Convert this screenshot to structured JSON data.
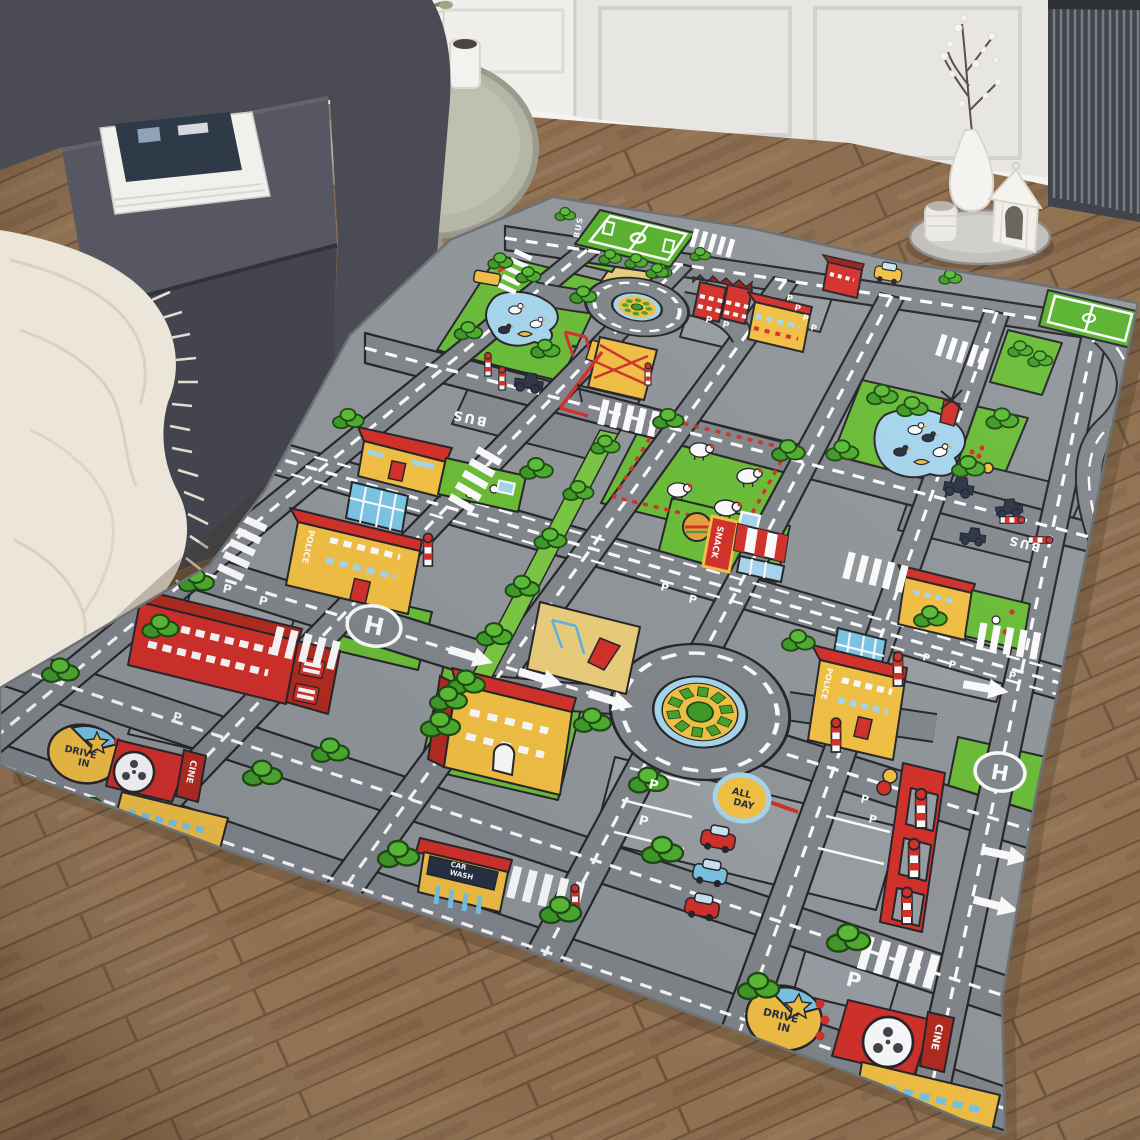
{
  "labels": {
    "snack": "SNACK",
    "police": "POLICE",
    "bus": "BUS",
    "cine": "CINE",
    "drive_in": [
      "DRIVE",
      "IN"
    ],
    "all_day": [
      "ALL",
      "DAY"
    ],
    "car_wash": [
      "CAR",
      "WASH"
    ],
    "parking": "P",
    "helipad": "H"
  },
  "colors": {
    "road": "#83888d",
    "rug_base": "#93989c",
    "grass": "#6cbf38",
    "pitch": "#58b32c",
    "yellow": "#f5c244",
    "red": "#d5312a",
    "water": "#a8d8ef",
    "sand": "#eccf7c",
    "navy": "#273043",
    "white": "#ffffff",
    "wood_floor": "#8a6a4c",
    "wall": "#e9e8e4",
    "sofa": "#4a4b54",
    "blanket": "#ece6da"
  },
  "rug_features": [
    "soccer-field",
    "roundabout",
    "duck-pond",
    "sheep-field",
    "snack-bar",
    "police-station",
    "fire-station",
    "helipad",
    "school",
    "playground",
    "construction-site",
    "car-wash",
    "drive-in-cinema",
    "parking-lot",
    "bus-lane",
    "crosswalk",
    "trees"
  ]
}
